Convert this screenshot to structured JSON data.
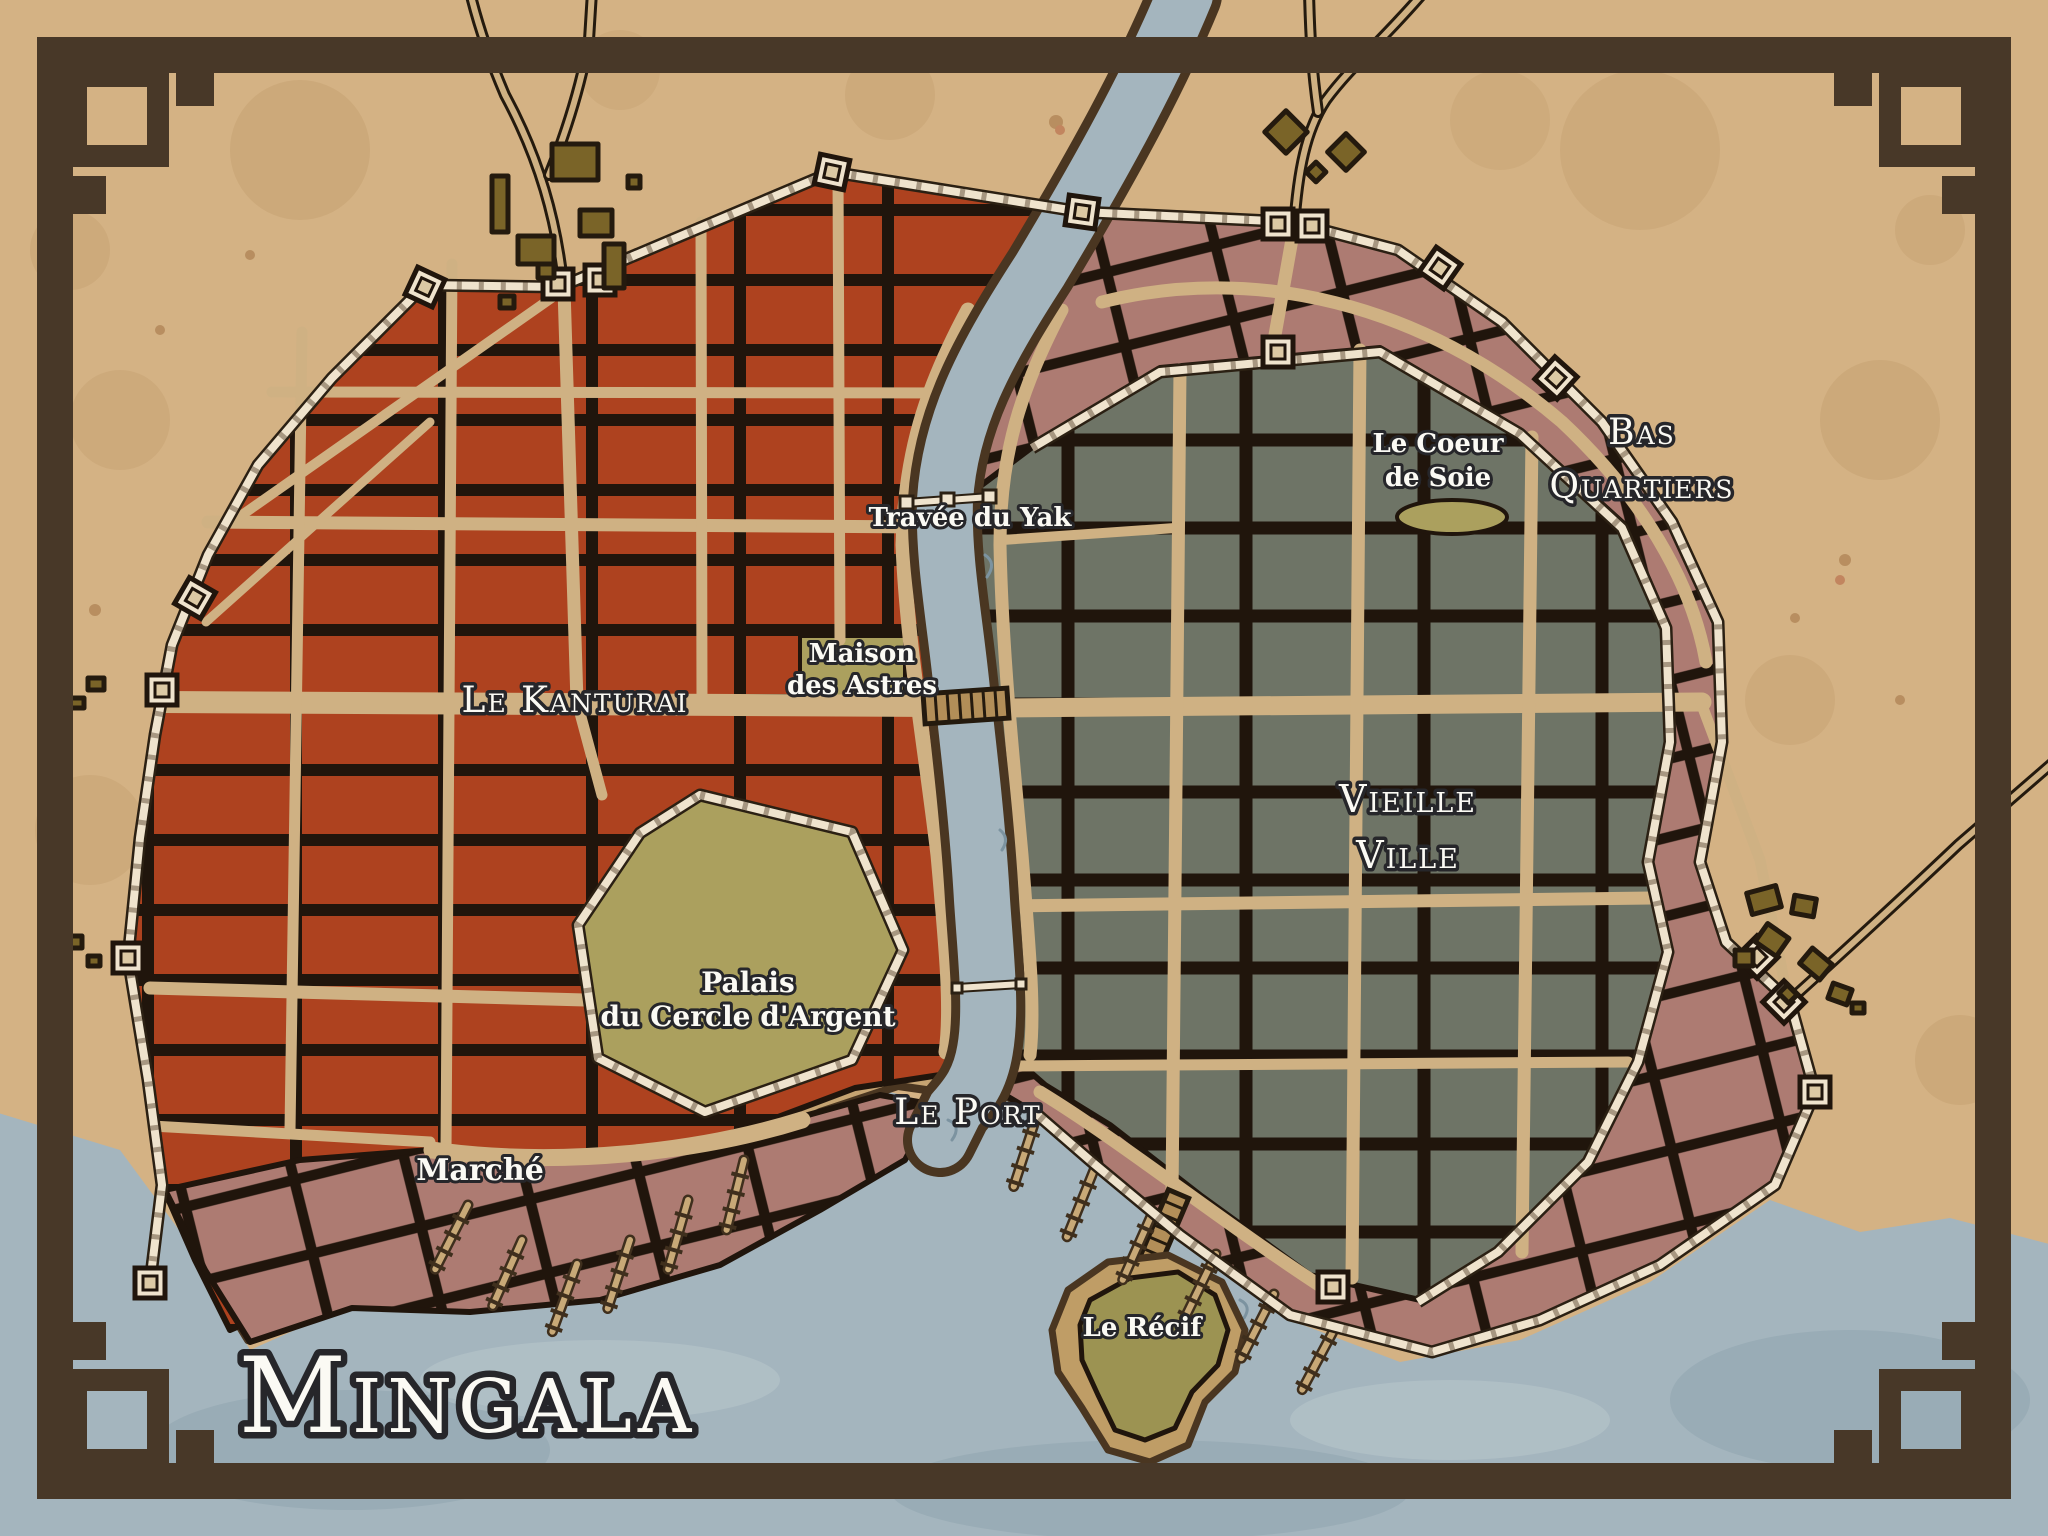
{
  "title": "Mingala",
  "labels": {
    "kanturai": "Le Kanturai",
    "vieille1": "Vieille",
    "vieille2": "Ville",
    "bas1": "Bas",
    "bas2": "Quartiers",
    "port": "Le Port",
    "marche": "Marché",
    "palais1": "Palais",
    "palais2": "du Cercle d'Argent",
    "maison1": "Maison",
    "maison2": "des Astres",
    "travee": "Travée du Yak",
    "coeur1": "Le Coeur",
    "coeur2": "de Soie",
    "recif": "Le Récif"
  },
  "colors": {
    "parchment": "#d4b284",
    "ground": "#c6a472",
    "street": "#cfb183",
    "red": "#ae421f",
    "gray": "#6e7466",
    "pink": "#ad7b72",
    "olive": "#aba05e",
    "olive2": "#9c9352",
    "beach": "#bf9d66",
    "water": "#a4b5be",
    "frame": "#483828",
    "wall": "#efe3cd",
    "ink": "#20150c",
    "coast": "#4a3621",
    "building": "#7a6428",
    "label": "#fbfaf4",
    "labelStroke": "#26262a"
  }
}
